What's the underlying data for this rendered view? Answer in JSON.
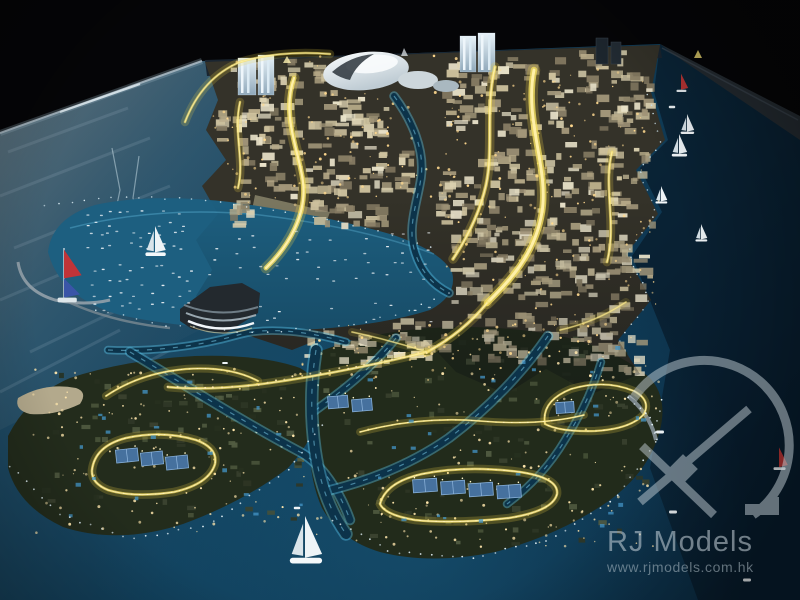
{
  "meta": {
    "description": "Night photograph of an illuminated architectural scale model of a waterfront city masterplan: dense city core with glowing yellow arterial roads, a white dome landmark, marina bay full of miniature boats, villa islands with lit road loops and tennis courts, surrounded by dark water with miniature sailboats",
    "alt": "Illuminated city masterplan scale model photographed at night"
  },
  "watermark": {
    "brand": "RJ Models",
    "website": "www.rjmodels.com.hk",
    "logo_icon": "drafting-compass-arc-logo",
    "color": "#c2cdd3"
  },
  "palette": {
    "background": "#050507",
    "water_deep": "#0a2a3e",
    "water_mid": "#12435e",
    "water_marina": "#1d5f80",
    "road_glow": "#f2df64",
    "road_bright": "#fff0a8",
    "canal_edge": "#55c6ea",
    "villa_land": "#232c1c",
    "city_land": "#343229",
    "dome_white": "#eef2f4",
    "tower_lit": "#c8dce8",
    "court_blue": "#46719e",
    "sand": "#b3a98c",
    "boat_white": "#eef4f7",
    "sail_red": "#b83434",
    "sail_blue": "#3a55a8",
    "building_palette": [
      "#ddd3b2",
      "#cec29e",
      "#b9ac8a",
      "#a3977a",
      "#8a7f66",
      "#e9e2c9"
    ],
    "villa_palette": [
      "#3a422f",
      "#2f3726",
      "#475138",
      "#525c42",
      "#27301f"
    ],
    "pool_color": "#4496c8",
    "boat_dot_color": "#e9eff3"
  },
  "scene": {
    "building_clusters": [
      [
        230,
        58,
        108,
        40,
        26
      ],
      [
        214,
        96,
        90,
        60,
        42
      ],
      [
        306,
        94,
        88,
        58,
        38
      ],
      [
        238,
        152,
        118,
        48,
        34
      ],
      [
        358,
        148,
        62,
        46,
        22
      ],
      [
        306,
        192,
        84,
        38,
        22
      ],
      [
        442,
        56,
        100,
        84,
        54
      ],
      [
        544,
        46,
        112,
        92,
        62
      ],
      [
        560,
        140,
        96,
        92,
        56
      ],
      [
        470,
        148,
        92,
        92,
        54
      ],
      [
        430,
        170,
        48,
        56,
        22
      ],
      [
        606,
        230,
        48,
        84,
        26
      ],
      [
        518,
        228,
        92,
        84,
        46
      ],
      [
        450,
        224,
        85,
        80,
        44
      ],
      [
        300,
        330,
        92,
        42,
        22
      ],
      [
        382,
        318,
        84,
        44,
        24
      ],
      [
        460,
        312,
        84,
        54,
        28
      ],
      [
        536,
        312,
        84,
        58,
        30
      ],
      [
        598,
        330,
        52,
        46,
        16
      ],
      [
        222,
        196,
        40,
        32,
        12
      ]
    ],
    "villa_clusters": [
      [
        34,
        372,
        272,
        150,
        72
      ],
      [
        320,
        336,
        330,
        210,
        95
      ]
    ],
    "window_dots": [
      [
        210,
        55,
        250,
        150,
        120
      ],
      [
        440,
        60,
        220,
        280,
        140
      ],
      [
        300,
        320,
        320,
        60,
        60
      ]
    ],
    "villa_dots": [
      [
        30,
        368,
        290,
        165,
        130
      ],
      [
        315,
        332,
        345,
        215,
        170
      ]
    ],
    "pools": [
      [
        44,
        380,
        256,
        140,
        20
      ],
      [
        332,
        342,
        310,
        195,
        26
      ]
    ],
    "boat_grids": [
      [
        82,
        208,
        104,
        42,
        4,
        10
      ],
      [
        88,
        262,
        104,
        50,
        4,
        9
      ],
      [
        205,
        228,
        230,
        55,
        4,
        12
      ],
      [
        250,
        300,
        190,
        26,
        2,
        10
      ]
    ],
    "dot_lines": [
      {
        "pts": [
          [
            45,
            205
          ],
          [
            120,
            196
          ],
          [
            200,
            200
          ],
          [
            280,
            210
          ],
          [
            360,
            226
          ],
          [
            430,
            248
          ]
        ],
        "n": 30,
        "c": "#dceef5",
        "r": 0.8
      },
      {
        "pts": [
          [
            95,
            310
          ],
          [
            170,
            326
          ],
          [
            250,
            332
          ],
          [
            330,
            328
          ],
          [
            400,
            315
          ],
          [
            448,
            292
          ]
        ],
        "n": 26,
        "c": "#dceef5",
        "r": 0.8
      },
      {
        "pts": [
          [
            10,
            466
          ],
          [
            60,
            514
          ],
          [
            130,
            540
          ],
          [
            210,
            524
          ],
          [
            290,
            468
          ],
          [
            322,
            424
          ]
        ],
        "n": 34,
        "c": "#e3f1f7",
        "r": 0.9
      },
      {
        "pts": [
          [
            332,
            520
          ],
          [
            392,
            552
          ],
          [
            470,
            558
          ],
          [
            550,
            539
          ],
          [
            614,
            499
          ],
          [
            655,
            444
          ],
          [
            661,
            400
          ]
        ],
        "n": 40,
        "c": "#e3f1f7",
        "r": 0.9
      },
      {
        "pts": [
          [
            648,
            95
          ],
          [
            661,
            144
          ],
          [
            640,
            170
          ],
          [
            656,
            214
          ],
          [
            628,
            252
          ],
          [
            649,
            300
          ],
          [
            620,
            340
          ]
        ],
        "n": 30,
        "c": "#cfe4ee",
        "r": 0.8
      },
      {
        "pts": [
          [
            628,
            398
          ],
          [
            650,
            416
          ],
          [
            656,
            440
          ]
        ],
        "n": 8,
        "c": "#e3f1f7",
        "r": 0.9
      },
      {
        "pts": [
          [
            168,
            387
          ],
          [
            240,
            388
          ],
          [
            310,
            374
          ],
          [
            380,
            362
          ],
          [
            427,
            352
          ]
        ],
        "n": 30,
        "c": "#ffe9b0",
        "r": 1.0
      }
    ],
    "roads": [
      {
        "d": "M 185,122 Q 202,78 240,62 Q 280,50 330,54",
        "w": 2.5,
        "o": 0.8
      },
      {
        "d": "M 294,78 C 281,116 299,150 303,182 C 307,214 289,246 266,268",
        "w": 5,
        "o": 1
      },
      {
        "d": "M 240,102 C 233,134 245,160 238,188",
        "w": 2.5,
        "o": 0.85
      },
      {
        "d": "M 534,70 C 524,120 549,168 542,212 C 535,256 507,283 487,303",
        "w": 6.5,
        "o": 1
      },
      {
        "d": "M 495,67 C 485,108 494,148 486,185 C 479,216 465,241 453,259",
        "w": 3.5,
        "o": 0.9
      },
      {
        "d": "M 612,152 C 603,186 617,224 607,262",
        "w": 2.8,
        "o": 0.85
      },
      {
        "d": "M 487,303 C 470,324 449,340 427,352",
        "w": 3.5,
        "o": 0.9
      },
      {
        "d": "M 427,352 C 378,364 328,374 283,381 C 238,388 198,390 168,387",
        "w": 2.8,
        "o": 0.85
      },
      {
        "d": "M 560,330 Q 596,322 626,302",
        "w": 2,
        "o": 0.6
      },
      {
        "d": "M 352,332 Q 390,340 427,352",
        "w": 2,
        "o": 0.6
      }
    ],
    "loops": [
      {
        "d": "M 92,470 Q 95,446 126,438 Q 162,430 196,440 Q 218,448 215,464 Q 209,484 174,492 Q 134,498 108,490 Q 91,483 92,470 Z",
        "w": 2.6
      },
      {
        "d": "M 380,504 Q 386,482 422,474 Q 466,465 520,472 Q 559,478 557,494 Q 553,511 509,518 Q 455,524 415,520 Q 385,515 380,504 Z",
        "w": 2.6
      },
      {
        "d": "M 106,396 Q 140,373 186,369 Q 230,366 258,381",
        "w": 2.2
      },
      {
        "d": "M 545,424 Q 541,401 571,389 Q 605,379 634,391 Q 651,400 644,414 Q 631,429 595,431 Q 560,432 545,424 Z",
        "w": 2.2
      },
      {
        "d": "M 360,432 Q 420,416 480,421 Q 540,426 584,415",
        "w": 1.8
      }
    ],
    "canals": [
      {
        "d": "M 394,96 C 412,120 425,150 421,178 C 417,204 407,228 415,252 C 421,272 433,285 449,293",
        "w": 6
      },
      {
        "d": "M 108,350 C 150,352 196,347 238,335 C 268,326 310,332 346,342",
        "w": 5
      },
      {
        "d": "M 130,352 C 180,382 240,420 300,452 C 322,464 340,492 350,520",
        "w": 7
      },
      {
        "d": "M 396,338 C 372,368 341,392 313,412",
        "w": 6
      },
      {
        "d": "M 548,336 C 523,372 489,408 449,438 C 413,463 371,480 331,490",
        "w": 7
      },
      {
        "d": "M 316,350 Q 308,400 315,450 Q 322,500 346,534",
        "w": 10
      },
      {
        "d": "M 601,362 Q 589,402 565,440 Q 543,477 507,504",
        "w": 5
      }
    ],
    "courts": [
      {
        "x": 116,
        "y": 449,
        "w": 22,
        "h": 13,
        "r": -6
      },
      {
        "x": 141,
        "y": 452,
        "w": 22,
        "h": 13,
        "r": -6
      },
      {
        "x": 166,
        "y": 456,
        "w": 22,
        "h": 13,
        "r": -6
      },
      {
        "x": 413,
        "y": 479,
        "w": 24,
        "h": 13,
        "r": -4
      },
      {
        "x": 441,
        "y": 481,
        "w": 24,
        "h": 13,
        "r": -4
      },
      {
        "x": 469,
        "y": 483,
        "w": 24,
        "h": 13,
        "r": -4
      },
      {
        "x": 497,
        "y": 485,
        "w": 24,
        "h": 13,
        "r": -4
      },
      {
        "x": 328,
        "y": 396,
        "w": 20,
        "h": 12,
        "r": -5
      },
      {
        "x": 352,
        "y": 399,
        "w": 20,
        "h": 12,
        "r": -5
      },
      {
        "x": 556,
        "y": 402,
        "w": 18,
        "h": 11,
        "r": -4
      }
    ],
    "boats": [
      {
        "x": 64,
        "y": 288,
        "k": "sail-redblue",
        "s": 1.6
      },
      {
        "x": 155,
        "y": 250,
        "k": "sail-white",
        "s": 1.2
      },
      {
        "x": 305,
        "y": 554,
        "k": "sail-white",
        "s": 1.9
      },
      {
        "x": 687,
        "y": 130,
        "k": "sail-white",
        "s": 0.8
      },
      {
        "x": 679,
        "y": 152,
        "k": "sail-white",
        "s": 0.9
      },
      {
        "x": 661,
        "y": 200,
        "k": "sail-white",
        "s": 0.7
      },
      {
        "x": 701,
        "y": 238,
        "k": "sail-white",
        "s": 0.7
      },
      {
        "x": 681,
        "y": 88,
        "k": "sail-red",
        "s": 0.9
      },
      {
        "x": 779,
        "y": 465,
        "k": "sail-red",
        "s": 1.1
      },
      {
        "x": 660,
        "y": 432,
        "k": "motor",
        "s": 1
      },
      {
        "x": 673,
        "y": 512,
        "k": "motor",
        "s": 1
      },
      {
        "x": 747,
        "y": 580,
        "k": "motor",
        "s": 1
      },
      {
        "x": 672,
        "y": 107,
        "k": "motor",
        "s": 0.8
      },
      {
        "x": 297,
        "y": 508,
        "k": "motor",
        "s": 0.8
      },
      {
        "x": 225,
        "y": 363,
        "k": "motor",
        "s": 0.7
      }
    ],
    "streaks": [
      [
        8,
        152,
        128,
        108
      ],
      [
        0,
        196,
        150,
        138
      ],
      [
        14,
        248,
        170,
        186
      ],
      [
        0,
        300,
        160,
        232
      ],
      [
        30,
        352,
        180,
        280
      ],
      [
        0,
        392,
        120,
        330
      ],
      [
        40,
        420,
        170,
        350
      ]
    ],
    "cracks": [
      [
        112,
        148,
        120,
        190,
        113,
        224,
        122,
        256
      ],
      [
        139,
        156,
        133,
        198,
        141,
        234
      ]
    ]
  }
}
